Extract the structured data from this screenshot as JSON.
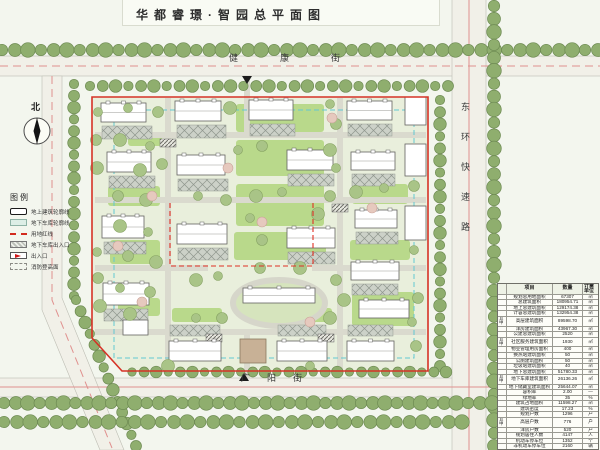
{
  "title": "华都睿璟·智园总平面图",
  "compass": {
    "label": "北"
  },
  "streets": {
    "top": "健康街",
    "right": "东环快速路",
    "bottom": "广阳街"
  },
  "legend": {
    "title": "图例",
    "items": [
      {
        "symbol": "building-outline",
        "label": "地上建筑轮廓线"
      },
      {
        "symbol": "garage-outline",
        "label": "地下车库轮廓线"
      },
      {
        "symbol": "red-line",
        "label": "用地红线"
      },
      {
        "symbol": "garage-entry",
        "label": "地下车库出入口"
      },
      {
        "symbol": "entrance",
        "label": "出入口"
      },
      {
        "symbol": "fire-zone",
        "label": "消防登高面"
      }
    ]
  },
  "table": {
    "headers": [
      "项目",
      "数量",
      "计量单位"
    ],
    "rows": [
      {
        "g": "",
        "label": "规划总用地面积",
        "value": "67307",
        "unit": "㎡"
      },
      {
        "g": "",
        "label": "总建筑面积",
        "value": "180954.71",
        "unit": "㎡"
      },
      {
        "g": "",
        "label": "地上总建筑面积",
        "value": "129174.38",
        "unit": "㎡"
      },
      {
        "g": "",
        "label": "计容总建筑面积",
        "value": "132954.38",
        "unit": "㎡"
      },
      {
        "g": "其中",
        "label": "高层建筑面积",
        "value": "89598.70",
        "unit": "㎡"
      },
      {
        "g": "其中",
        "label": "洋房建筑面积",
        "value": "43967.30",
        "unit": "㎡"
      },
      {
        "g": "",
        "label": "公建总建筑面积",
        "value": "2520",
        "unit": "㎡"
      },
      {
        "g": "其中",
        "label": "社区服务建筑面积",
        "value": "1930",
        "unit": "㎡"
      },
      {
        "g": "其中",
        "label": "物业管理用房面积",
        "value": "400",
        "unit": "㎡"
      },
      {
        "g": "其中",
        "label": "换热站建筑面积",
        "value": "50",
        "unit": "㎡"
      },
      {
        "g": "其中",
        "label": "公厕建筑面积",
        "value": "50",
        "unit": "㎡"
      },
      {
        "g": "其中",
        "label": "垃圾站建筑面积",
        "value": "40",
        "unit": "㎡"
      },
      {
        "g": "",
        "label": "地下总建筑面积",
        "value": "51780.33",
        "unit": "㎡"
      },
      {
        "g": "其中",
        "label": "地下车库建筑面积",
        "value": "26136.26",
        "unit": "㎡"
      },
      {
        "g": "其中",
        "label": "地下储藏室建筑面积",
        "value": "25644.07",
        "unit": "㎡"
      },
      {
        "g": "",
        "label": "容积率",
        "value": "2.00",
        "unit": "—"
      },
      {
        "g": "",
        "label": "绿地率",
        "value": "35",
        "unit": "%"
      },
      {
        "g": "",
        "label": "建筑占地面积",
        "value": "11598.27",
        "unit": "㎡"
      },
      {
        "g": "",
        "label": "建筑密度",
        "value": "17.23",
        "unit": "%"
      },
      {
        "g": "",
        "label": "规划户数",
        "value": "1296",
        "unit": "户"
      },
      {
        "g": "其中",
        "label": "高层户数",
        "value": "776",
        "unit": "户"
      },
      {
        "g": "其中",
        "label": "洋房户数",
        "value": "520",
        "unit": "户"
      },
      {
        "g": "",
        "label": "规划居住人数",
        "value": "4147",
        "unit": "人"
      },
      {
        "g": "",
        "label": "机动车停车位",
        "value": "1352",
        "unit": "个"
      },
      {
        "g": "",
        "label": "非机动车停车位",
        "value": "2160",
        "unit": "辆"
      }
    ]
  },
  "colors": {
    "boundary_red": "#d63226",
    "garage_blue": "#62c8d2",
    "road_centerline_pink": "#e0908e",
    "street_tree_green": "#8fae6e",
    "site_tree_green": "#a9c487",
    "lawn_green": "#b9d98b",
    "paper": "#f3f6ee"
  }
}
